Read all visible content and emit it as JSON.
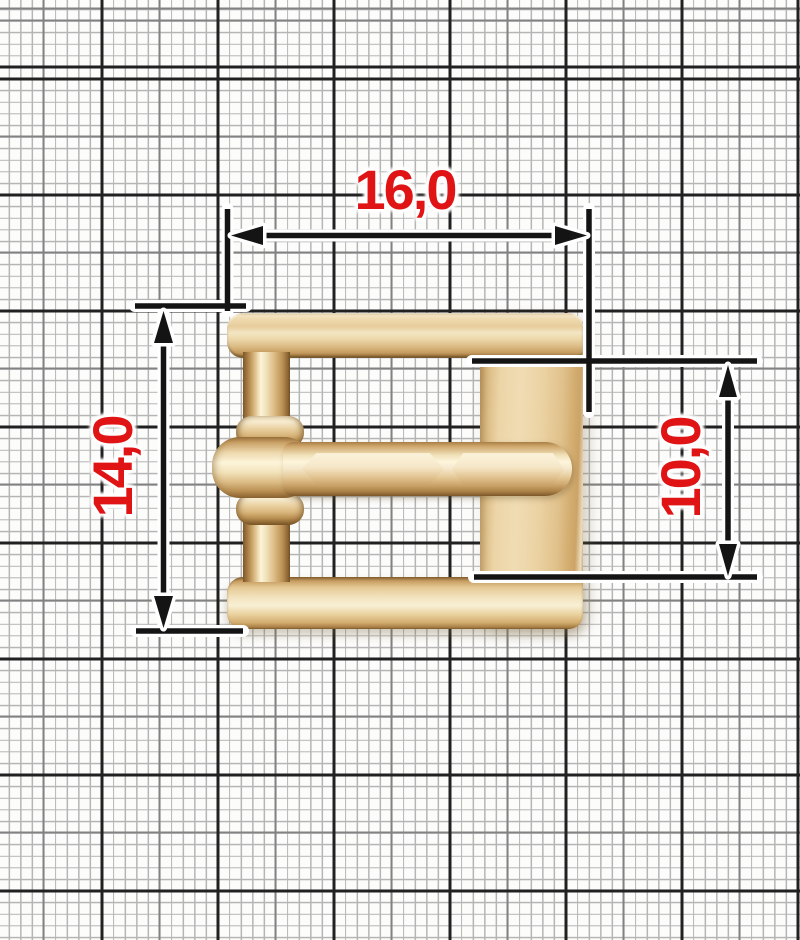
{
  "scene": {
    "object": "roller pin buckle on millimeter graph paper",
    "dimensions": {
      "width_label": "16,0",
      "height_label": "14,0",
      "inner_height_label": "10,0"
    },
    "colors": {
      "label_red": "#e01414",
      "dimension_line_black": "#141414",
      "casing_white": "#ffffff",
      "metal_highlight": "#fdf4d8",
      "metal_base": "#e8cf9f",
      "metal_shadow": "#7d5a2c",
      "paper_background": "#fcfcfb",
      "grid_thin": "#b5b5b5",
      "grid_medium": "#828282",
      "grid_thick": "#212121"
    }
  }
}
